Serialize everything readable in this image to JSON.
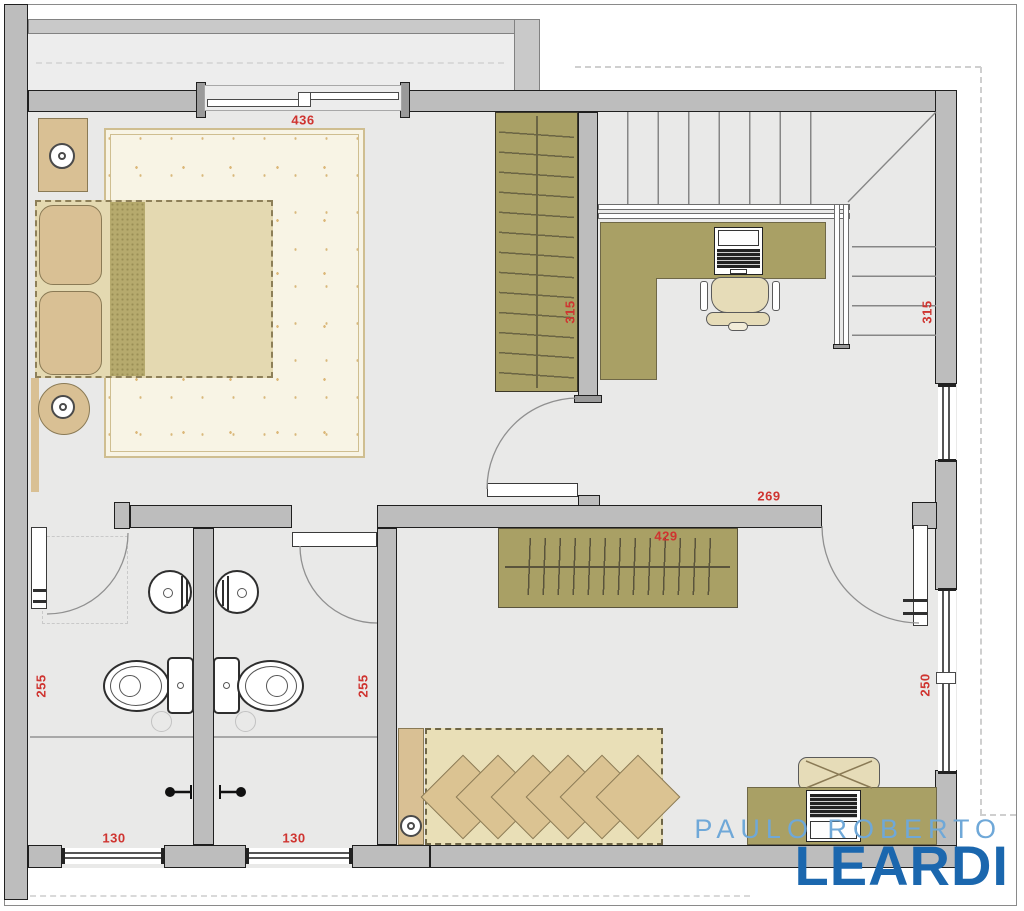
{
  "dimensions": {
    "window_top": "436",
    "closet_master": "315",
    "stairs": "315",
    "hall": "269",
    "wardrobe": "429",
    "bath1": "255",
    "bath2": "255",
    "window_right": "250",
    "bath1_window": "130",
    "bath2_window": "130"
  },
  "watermark": {
    "line1": "PAULO ROBERTO",
    "line2": "LEARDI"
  },
  "colors": {
    "dimension_text": "#cf3430",
    "watermark_light": "#6fa8d8",
    "watermark_dark": "#1b67ae",
    "wall_fill": "#bdbdbd",
    "floor_fill": "#e9e9e8",
    "wood_fill": "#a9a065",
    "furniture_tan": "#d9c094"
  },
  "icons": [
    "bed-icon",
    "pillow-icon",
    "rug-icon",
    "nightstand-lamp-icon",
    "side-table-lamp-icon",
    "closet-hangers-icon",
    "stairs-icon",
    "desk-icon",
    "laptop-icon",
    "office-chair-icon",
    "sink-icon",
    "toilet-icon",
    "shower-head-icon",
    "floor-drain-icon",
    "door-swing-icon",
    "window-icon",
    "wardrobe-icon",
    "sofa-bed-icon"
  ]
}
